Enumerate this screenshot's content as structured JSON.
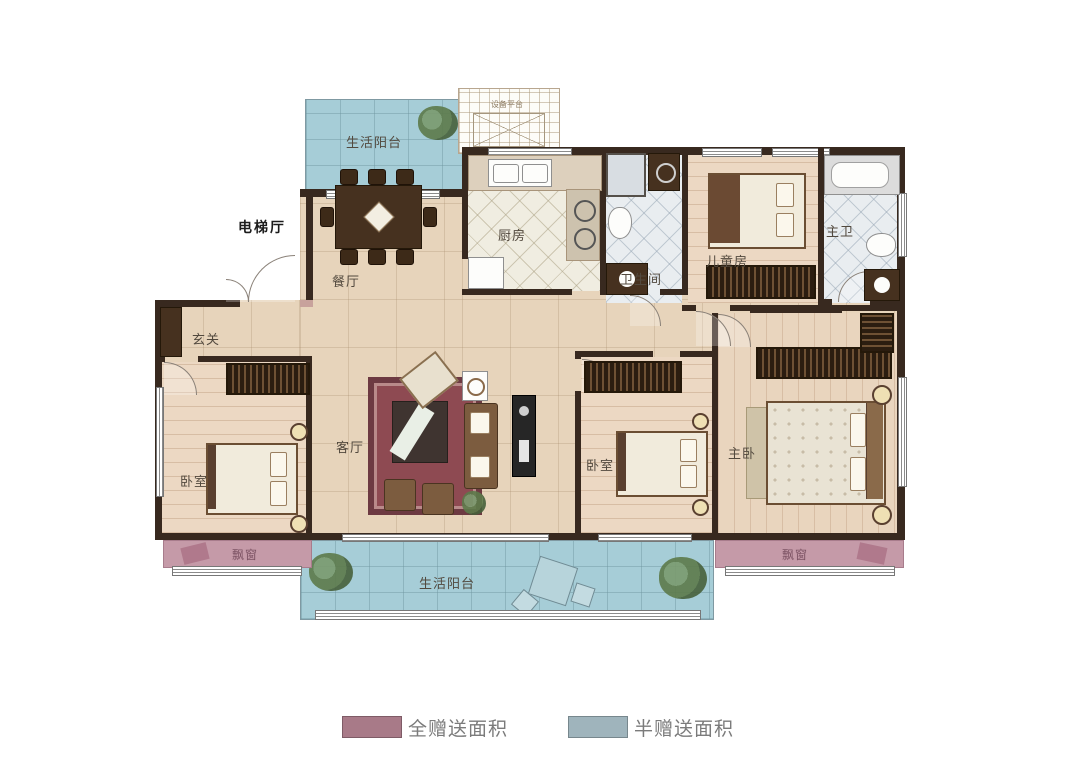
{
  "rooms": {
    "balcony_top": {
      "label": "生活阳台"
    },
    "equipment_platform": {
      "label": "设备平台"
    },
    "dining": {
      "label": "餐厅"
    },
    "kitchen": {
      "label": "厨房"
    },
    "elevator_hall": {
      "label": "电梯厅"
    },
    "bathroom": {
      "label": "卫生间"
    },
    "kids_room": {
      "label": "儿童房"
    },
    "master_bath": {
      "label": "主卫"
    },
    "foyer": {
      "label": "玄关"
    },
    "living": {
      "label": "客厅"
    },
    "bedroom_left": {
      "label": "卧室"
    },
    "bedroom_mid": {
      "label": "卧室"
    },
    "master_bedroom": {
      "label": "主卧"
    },
    "bay_window_left": {
      "label": "飘窗"
    },
    "bay_window_right": {
      "label": "飘窗"
    },
    "balcony_bottom": {
      "label": "生活阳台"
    }
  },
  "legend": {
    "items": [
      {
        "label": "全赠送面积",
        "color": "#a87a88"
      },
      {
        "label": "半赠送面积",
        "color": "#9fb4bc"
      }
    ]
  }
}
